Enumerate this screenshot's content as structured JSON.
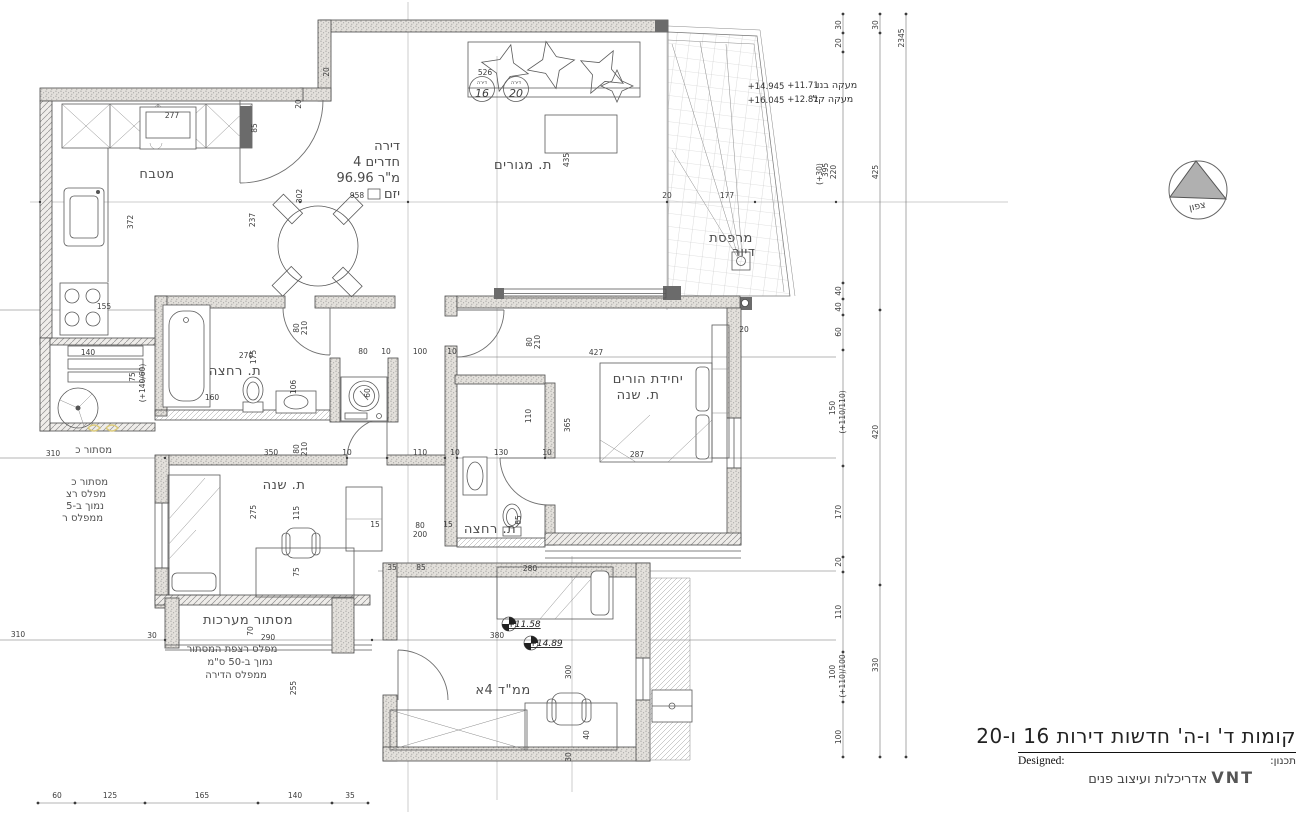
{
  "title_block": {
    "line1": "קומות ד' ו-ה' חדשות דירות 16 ו-20",
    "designed_label": "Designed:",
    "planning_label": "תכנון:",
    "firm_name": "VNT",
    "firm_desc": "אדריכלות ועיצוב פנים"
  },
  "north_arrow": {
    "label": "צפון"
  },
  "apartment": {
    "c1": {
      "label": "דירה",
      "num": "16"
    },
    "c2": {
      "label": "דירה",
      "num": "20"
    }
  },
  "colors": {
    "line": "#4a4a4a",
    "wall_fill": "#e3e0db",
    "highlight_yellow": "#d9c878"
  },
  "annotations": [
    {
      "t": "מטבח",
      "x": 157,
      "y": 178,
      "c": "room"
    },
    {
      "t": "ת. מגורים",
      "x": 523,
      "y": 169,
      "c": "room"
    },
    {
      "t": "ת. רחצה",
      "x": 235,
      "y": 375,
      "c": "room",
      "s": 11.5
    },
    {
      "t": "יחידת הורים",
      "x": 648,
      "y": 383,
      "c": "room",
      "s": 12
    },
    {
      "t": "ת. שנה",
      "x": 638,
      "y": 399,
      "c": "room",
      "s": 12
    },
    {
      "t": "ת. שנה",
      "x": 284,
      "y": 489,
      "c": "room",
      "s": 12
    },
    {
      "t": "ת. רחצה",
      "x": 490,
      "y": 533,
      "c": "room",
      "s": 11
    },
    {
      "t": "ממ\"ד 4א",
      "x": 503,
      "y": 694,
      "c": "room",
      "s": 13.5
    },
    {
      "t": "מסתור מערכות",
      "x": 248,
      "y": 624,
      "c": "room",
      "s": 11.5
    },
    {
      "t": "מרפסת",
      "x": 731,
      "y": 242,
      "c": "room",
      "s": 10.5
    },
    {
      "t": "דיור",
      "x": 744,
      "y": 256,
      "c": "room",
      "s": 10.5
    },
    {
      "t": "דירה",
      "x": 400,
      "y": 150,
      "c": "info",
      "a": "end"
    },
    {
      "t": "4 חדרים",
      "x": 400,
      "y": 166,
      "c": "info",
      "a": "end"
    },
    {
      "t": "96.96 מ\"ר",
      "x": 400,
      "y": 182,
      "c": "info",
      "a": "end"
    },
    {
      "t": "יזם",
      "x": 400,
      "y": 198,
      "c": "info",
      "a": "end",
      "s": 11
    },
    {
      "t": "מסתור כ",
      "x": 112,
      "y": 453,
      "c": "note",
      "a": "end"
    },
    {
      "t": "מסתור כ",
      "x": 108,
      "y": 485,
      "c": "note",
      "a": "end"
    },
    {
      "t": "מפלס רצ",
      "x": 106,
      "y": 497,
      "c": "note",
      "a": "end"
    },
    {
      "t": "נמוך ב-5",
      "x": 104,
      "y": 509,
      "c": "note",
      "a": "end"
    },
    {
      "t": "ממפלס ר",
      "x": 103,
      "y": 521,
      "c": "note",
      "a": "end"
    },
    {
      "t": "מפלס רצפת המסתור",
      "x": 232,
      "y": 652,
      "c": "note",
      "s": 10.5
    },
    {
      "t": "נמוך ב-50 ס\"מ",
      "x": 240,
      "y": 665,
      "c": "note",
      "s": 10.5
    },
    {
      "t": "ממפלס הדירה",
      "x": 236,
      "y": 678,
      "c": "note",
      "s": 10.5
    },
    {
      "t": "+14.945",
      "x": 766,
      "y": 89,
      "c": "level"
    },
    {
      "t": "+11.71",
      "x": 803,
      "y": 88,
      "c": "level"
    },
    {
      "t": "מעקה בנוי",
      "x": 836,
      "y": 88,
      "c": "levelheb"
    },
    {
      "t": "+16.045",
      "x": 766,
      "y": 103,
      "c": "level"
    },
    {
      "t": "+12.81",
      "x": 803,
      "y": 102,
      "c": "level"
    },
    {
      "t": "מעקה קל",
      "x": 833,
      "y": 102,
      "c": "levelheb"
    },
    {
      "t": "+11.58",
      "x": 524,
      "y": 627,
      "c": "levelmark"
    },
    {
      "t": "+14.89",
      "x": 546,
      "y": 646,
      "c": "levelmark"
    },
    {
      "t": "277",
      "x": 172,
      "y": 118
    },
    {
      "t": "526",
      "x": 485,
      "y": 75
    },
    {
      "t": "958",
      "x": 357,
      "y": 198
    },
    {
      "t": "302",
      "x": 302,
      "y": 196,
      "rot": -90
    },
    {
      "t": "177",
      "x": 727,
      "y": 198
    },
    {
      "t": "20",
      "x": 667,
      "y": 198
    },
    {
      "t": "435",
      "x": 569,
      "y": 160,
      "rot": -90
    },
    {
      "t": "372",
      "x": 133,
      "y": 222,
      "rot": -90
    },
    {
      "t": "237",
      "x": 255,
      "y": 220,
      "rot": -90
    },
    {
      "t": "85",
      "x": 257,
      "y": 128,
      "rot": -90
    },
    {
      "t": "20",
      "x": 329,
      "y": 72,
      "rot": -90
    },
    {
      "t": "20",
      "x": 301,
      "y": 104,
      "rot": -90
    },
    {
      "t": "155",
      "x": 104,
      "y": 309
    },
    {
      "t": "140",
      "x": 88,
      "y": 355
    },
    {
      "t": "75",
      "x": 135,
      "y": 377,
      "rot": -90
    },
    {
      "t": "(+140/60)",
      "x": 145,
      "y": 383,
      "rot": -90,
      "s": 5.5
    },
    {
      "t": "310",
      "x": 53,
      "y": 456
    },
    {
      "t": "270",
      "x": 246,
      "y": 358
    },
    {
      "t": "175",
      "x": 256,
      "y": 357,
      "rot": -90
    },
    {
      "t": "160",
      "x": 212,
      "y": 400
    },
    {
      "t": "106",
      "x": 296,
      "y": 387,
      "rot": -90
    },
    {
      "t": "80",
      "x": 299,
      "y": 328,
      "rot": -90
    },
    {
      "t": "210",
      "x": 307,
      "y": 328,
      "rot": -90
    },
    {
      "t": "80",
      "x": 363,
      "y": 354
    },
    {
      "t": "10",
      "x": 386,
      "y": 354
    },
    {
      "t": "100",
      "x": 420,
      "y": 354
    },
    {
      "t": "10",
      "x": 452,
      "y": 354
    },
    {
      "t": "60",
      "x": 370,
      "y": 393,
      "rot": -90
    },
    {
      "t": "427",
      "x": 596,
      "y": 355
    },
    {
      "t": "20",
      "x": 744,
      "y": 332
    },
    {
      "t": "80",
      "x": 532,
      "y": 342,
      "rot": -90
    },
    {
      "t": "210",
      "x": 540,
      "y": 342,
      "rot": -90
    },
    {
      "t": "110",
      "x": 531,
      "y": 416,
      "rot": -90
    },
    {
      "t": "365",
      "x": 570,
      "y": 425,
      "rot": -90
    },
    {
      "t": "287",
      "x": 637,
      "y": 457
    },
    {
      "t": "350",
      "x": 271,
      "y": 455
    },
    {
      "t": "10",
      "x": 347,
      "y": 455
    },
    {
      "t": "110",
      "x": 420,
      "y": 455
    },
    {
      "t": "10",
      "x": 455,
      "y": 455
    },
    {
      "t": "130",
      "x": 501,
      "y": 455
    },
    {
      "t": "10",
      "x": 547,
      "y": 455
    },
    {
      "t": "80",
      "x": 299,
      "y": 449,
      "rot": -90
    },
    {
      "t": "210",
      "x": 307,
      "y": 449,
      "rot": -90
    },
    {
      "t": "65",
      "x": 521,
      "y": 520,
      "rot": -90
    },
    {
      "t": "15",
      "x": 375,
      "y": 527
    },
    {
      "t": "80",
      "x": 420,
      "y": 528
    },
    {
      "t": "200",
      "x": 420,
      "y": 537
    },
    {
      "t": "15",
      "x": 448,
      "y": 527
    },
    {
      "t": "275",
      "x": 256,
      "y": 512,
      "rot": -90
    },
    {
      "t": "115",
      "x": 299,
      "y": 513,
      "rot": -90
    },
    {
      "t": "75",
      "x": 299,
      "y": 572,
      "rot": -90
    },
    {
      "t": "280",
      "x": 530,
      "y": 571
    },
    {
      "t": "35",
      "x": 392,
      "y": 570
    },
    {
      "t": "85",
      "x": 421,
      "y": 570
    },
    {
      "t": "70",
      "x": 253,
      "y": 631,
      "rot": -90
    },
    {
      "t": "290",
      "x": 268,
      "y": 640
    },
    {
      "t": "30",
      "x": 152,
      "y": 638
    },
    {
      "t": "310",
      "x": 18,
      "y": 637
    },
    {
      "t": "380",
      "x": 497,
      "y": 638
    },
    {
      "t": "300",
      "x": 571,
      "y": 672,
      "rot": -90
    },
    {
      "t": "255",
      "x": 296,
      "y": 688,
      "rot": -90
    },
    {
      "t": "30",
      "x": 571,
      "y": 757,
      "rot": -90
    },
    {
      "t": "40",
      "x": 589,
      "y": 735,
      "rot": -90
    },
    {
      "t": "60",
      "x": 57,
      "y": 798
    },
    {
      "t": "125",
      "x": 110,
      "y": 798
    },
    {
      "t": "165",
      "x": 202,
      "y": 798
    },
    {
      "t": "140",
      "x": 295,
      "y": 798
    },
    {
      "t": "35",
      "x": 350,
      "y": 798
    },
    {
      "t": "30",
      "x": 841,
      "y": 25,
      "rot": -90
    },
    {
      "t": "20",
      "x": 841,
      "y": 43,
      "rot": -90
    },
    {
      "t": "395",
      "x": 828,
      "y": 170,
      "rot": -90
    },
    {
      "t": "220",
      "x": 836,
      "y": 172,
      "rot": -90
    },
    {
      "t": "(+30)",
      "x": 822,
      "y": 174,
      "rot": -90,
      "s": 5.5
    },
    {
      "t": "40",
      "x": 841,
      "y": 291,
      "rot": -90
    },
    {
      "t": "40",
      "x": 841,
      "y": 307,
      "rot": -90
    },
    {
      "t": "60",
      "x": 841,
      "y": 332,
      "rot": -90
    },
    {
      "t": "150",
      "x": 835,
      "y": 408,
      "rot": -90
    },
    {
      "t": "(+110/110)",
      "x": 845,
      "y": 412,
      "rot": -90,
      "s": 5.5
    },
    {
      "t": "170",
      "x": 841,
      "y": 512,
      "rot": -90
    },
    {
      "t": "20",
      "x": 841,
      "y": 562,
      "rot": -90
    },
    {
      "t": "110",
      "x": 841,
      "y": 612,
      "rot": -90
    },
    {
      "t": "100",
      "x": 835,
      "y": 672,
      "rot": -90
    },
    {
      "t": "(+110)/100",
      "x": 845,
      "y": 676,
      "rot": -90,
      "s": 5.5
    },
    {
      "t": "100",
      "x": 841,
      "y": 737,
      "rot": -90
    },
    {
      "t": "30",
      "x": 878,
      "y": 25,
      "rot": -90
    },
    {
      "t": "425",
      "x": 878,
      "y": 172,
      "rot": -90
    },
    {
      "t": "420",
      "x": 878,
      "y": 432,
      "rot": -90
    },
    {
      "t": "330",
      "x": 878,
      "y": 665,
      "rot": -90
    },
    {
      "t": "2345",
      "x": 904,
      "y": 38,
      "rot": -90
    }
  ]
}
